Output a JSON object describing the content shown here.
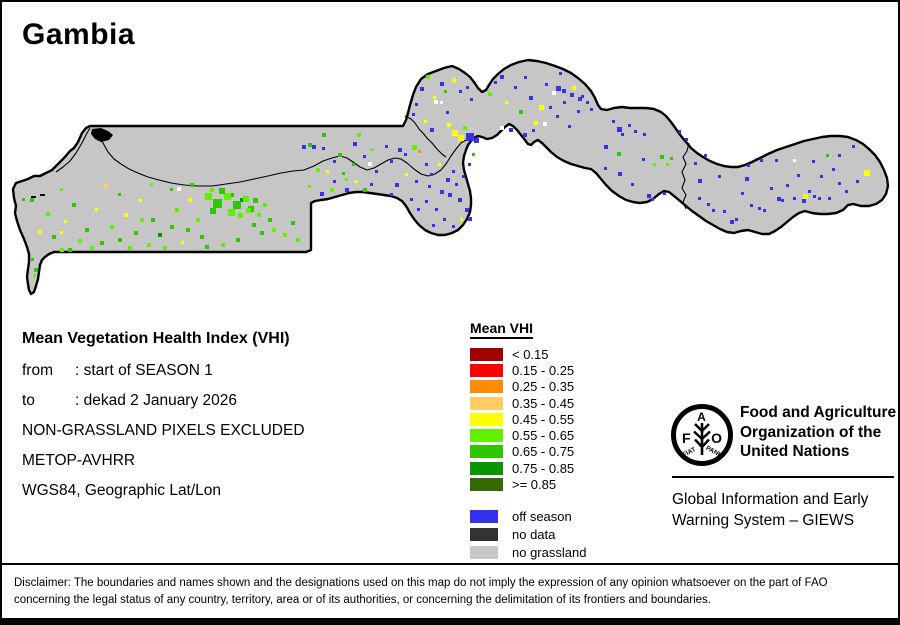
{
  "title": "Gambia",
  "info": {
    "heading": "Mean Vegetation Health Index (VHI)",
    "rows": [
      {
        "label": "from",
        "value": ": start of SEASON 1"
      },
      {
        "label": "to",
        "value": ": dekad 2 January 2026"
      }
    ],
    "lines": [
      "NON-GRASSLAND PIXELS EXCLUDED",
      "METOP-AVHRR",
      "WGS84, Geographic Lat/Lon"
    ]
  },
  "legend": {
    "title": "Mean VHI",
    "classes": [
      {
        "label": "< 0.15",
        "color": "#A00000"
      },
      {
        "label": "0.15 - 0.25",
        "color": "#FF0000"
      },
      {
        "label": "0.25 - 0.35",
        "color": "#FF8C00"
      },
      {
        "label": "0.35 - 0.45",
        "color": "#FFCC66"
      },
      {
        "label": "0.45 - 0.55",
        "color": "#FFFF00"
      },
      {
        "label": "0.55 - 0.65",
        "color": "#63F000"
      },
      {
        "label": "0.65 - 0.75",
        "color": "#2FC800"
      },
      {
        "label": "0.75 - 0.85",
        "color": "#0A9600"
      },
      {
        "label": ">= 0.85",
        "color": "#336B00"
      }
    ],
    "extra": [
      {
        "label": "off season",
        "color": "#3333EE"
      },
      {
        "label": "no data",
        "color": "#333333"
      },
      {
        "label": "no grassland",
        "color": "#C8C8C8"
      }
    ]
  },
  "org": {
    "logo": {
      "f": "F",
      "a": "A",
      "o": "O",
      "fiat": "FIAT",
      "panis": "PANIS"
    },
    "name_lines": [
      "Food and Agriculture",
      "Organization of the",
      "United Nations"
    ],
    "giews_lines": [
      "Global Information and Early",
      "Warning System – GIEWS"
    ]
  },
  "disclaimer": {
    "line1": "Disclaimer: The boundaries and names shown and the designations used on this map do not imply the expression of any opinion whatsoever on the part of FAO",
    "line2": "concerning the legal status of any country, territory, area or of its authorities, or concerning the delimitation of its frontiers and boundaries."
  },
  "map": {
    "land_color": "#C6C6C6",
    "pixel_colors": {
      "G1": "#63F000",
      "G2": "#2FC800",
      "G3": "#0A9600",
      "G4": "#336B00",
      "Y": "#FFFF00",
      "T": "#FFCC66",
      "O": "#FF9100",
      "B": "#3333EE",
      "W": "#FFFFFF"
    },
    "pixels": [
      [
        30,
        196,
        4,
        "G2"
      ],
      [
        22,
        196,
        3,
        "G2"
      ],
      [
        38,
        228,
        4,
        "Y"
      ],
      [
        46,
        210,
        4,
        "G1"
      ],
      [
        52,
        233,
        4,
        "G2"
      ],
      [
        60,
        246,
        4,
        "G1"
      ],
      [
        64,
        218,
        3,
        "Y"
      ],
      [
        60,
        229,
        3,
        "Y"
      ],
      [
        60,
        186,
        3,
        "G1"
      ],
      [
        68,
        246,
        4,
        "G2"
      ],
      [
        72,
        201,
        4,
        "G2"
      ],
      [
        78,
        237,
        4,
        "G1"
      ],
      [
        85,
        226,
        4,
        "G2"
      ],
      [
        90,
        244,
        4,
        "G1"
      ],
      [
        95,
        206,
        3,
        "Y"
      ],
      [
        100,
        239,
        4,
        "G2"
      ],
      [
        104,
        182,
        4,
        "T"
      ],
      [
        110,
        223,
        4,
        "G1"
      ],
      [
        118,
        236,
        4,
        "G2"
      ],
      [
        118,
        191,
        3,
        "G2"
      ],
      [
        124,
        211,
        4,
        "Y"
      ],
      [
        128,
        244,
        4,
        "G1"
      ],
      [
        134,
        229,
        4,
        "G2"
      ],
      [
        139,
        197,
        3,
        "Y"
      ],
      [
        140,
        216,
        4,
        "G1"
      ],
      [
        147,
        241,
        4,
        "G1"
      ],
      [
        151,
        216,
        4,
        "G2"
      ],
      [
        150,
        181,
        3,
        "G1"
      ],
      [
        158,
        231,
        4,
        "G3"
      ],
      [
        163,
        244,
        4,
        "G1"
      ],
      [
        170,
        223,
        4,
        "G2"
      ],
      [
        170,
        186,
        3,
        "G2"
      ],
      [
        175,
        206,
        4,
        "G1"
      ],
      [
        177,
        185,
        4,
        "W"
      ],
      [
        181,
        239,
        3,
        "Y"
      ],
      [
        186,
        226,
        4,
        "G2"
      ],
      [
        188,
        196,
        4,
        "Y"
      ],
      [
        190,
        181,
        4,
        "G2"
      ],
      [
        196,
        216,
        4,
        "G1"
      ],
      [
        200,
        233,
        4,
        "G2"
      ],
      [
        205,
        243,
        4,
        "G2"
      ],
      [
        210,
        186,
        4,
        "G1"
      ],
      [
        221,
        241,
        4,
        "G1"
      ],
      [
        230,
        191,
        4,
        "G2"
      ],
      [
        236,
        236,
        4,
        "G2"
      ],
      [
        240,
        196,
        4,
        "G3"
      ],
      [
        252,
        221,
        4,
        "G2"
      ],
      [
        257,
        211,
        4,
        "G1"
      ],
      [
        260,
        229,
        4,
        "G2"
      ],
      [
        263,
        201,
        4,
        "G1"
      ],
      [
        268,
        216,
        4,
        "G2"
      ],
      [
        272,
        226,
        4,
        "G1"
      ],
      [
        283,
        231,
        4,
        "G1"
      ],
      [
        291,
        219,
        4,
        "G2"
      ],
      [
        296,
        236,
        4,
        "G1"
      ],
      [
        34,
        266,
        4,
        "G2"
      ],
      [
        31,
        256,
        3,
        "G2"
      ],
      [
        33,
        272,
        3,
        "G1"
      ],
      [
        205,
        191,
        7,
        "G1"
      ],
      [
        213,
        197,
        9,
        "G2"
      ],
      [
        224,
        191,
        7,
        "G1"
      ],
      [
        233,
        199,
        8,
        "G2"
      ],
      [
        243,
        194,
        6,
        "G1"
      ],
      [
        210,
        206,
        6,
        "G2"
      ],
      [
        228,
        207,
        7,
        "G1"
      ],
      [
        248,
        204,
        6,
        "G2"
      ],
      [
        219,
        186,
        6,
        "G2"
      ],
      [
        238,
        211,
        5,
        "G1"
      ],
      [
        253,
        196,
        5,
        "G2"
      ],
      [
        246,
        206,
        5,
        "G1"
      ],
      [
        308,
        141,
        4,
        "G2"
      ],
      [
        316,
        166,
        4,
        "G1"
      ],
      [
        322,
        131,
        4,
        "G2"
      ],
      [
        330,
        186,
        4,
        "G1"
      ],
      [
        338,
        151,
        4,
        "G2"
      ],
      [
        345,
        176,
        3,
        "G1"
      ],
      [
        352,
        161,
        3,
        "G2"
      ],
      [
        357,
        131,
        4,
        "G1"
      ],
      [
        363,
        186,
        4,
        "G2"
      ],
      [
        370,
        146,
        3,
        "G1"
      ],
      [
        302,
        143,
        4,
        "B"
      ],
      [
        312,
        143,
        4,
        "B"
      ],
      [
        322,
        145,
        3,
        "B"
      ],
      [
        333,
        158,
        3,
        "B"
      ],
      [
        353,
        140,
        4,
        "B"
      ],
      [
        363,
        153,
        3,
        "B"
      ],
      [
        375,
        168,
        3,
        "B"
      ],
      [
        385,
        143,
        3,
        "B"
      ],
      [
        390,
        158,
        3,
        "B"
      ],
      [
        368,
        160,
        4,
        "W"
      ],
      [
        342,
        170,
        3,
        "G2"
      ],
      [
        333,
        178,
        3,
        "B"
      ],
      [
        345,
        186,
        4,
        "B"
      ],
      [
        355,
        178,
        3,
        "Y"
      ],
      [
        320,
        190,
        4,
        "B"
      ],
      [
        308,
        183,
        3,
        "G1"
      ],
      [
        326,
        168,
        3,
        "Y"
      ],
      [
        398,
        146,
        4,
        "B"
      ],
      [
        404,
        151,
        3,
        "B"
      ],
      [
        412,
        143,
        5,
        "G1"
      ],
      [
        418,
        148,
        3,
        "O"
      ],
      [
        425,
        161,
        3,
        "B"
      ],
      [
        430,
        171,
        3,
        "B"
      ],
      [
        438,
        161,
        3,
        "Y"
      ],
      [
        446,
        176,
        4,
        "B"
      ],
      [
        452,
        168,
        3,
        "B"
      ],
      [
        440,
        188,
        4,
        "B"
      ],
      [
        428,
        183,
        3,
        "B"
      ],
      [
        415,
        178,
        3,
        "B"
      ],
      [
        405,
        171,
        3,
        "Y"
      ],
      [
        395,
        181,
        4,
        "B"
      ],
      [
        390,
        191,
        3,
        "B"
      ],
      [
        370,
        181,
        3,
        "B"
      ],
      [
        448,
        191,
        4,
        "B"
      ],
      [
        455,
        181,
        3,
        "B"
      ],
      [
        462,
        173,
        3,
        "B"
      ],
      [
        458,
        196,
        4,
        "B"
      ],
      [
        465,
        206,
        4,
        "B"
      ],
      [
        468,
        215,
        4,
        "B"
      ],
      [
        460,
        216,
        3,
        "Y"
      ],
      [
        452,
        223,
        3,
        "B"
      ],
      [
        443,
        216,
        3,
        "B"
      ],
      [
        435,
        206,
        3,
        "B"
      ],
      [
        425,
        198,
        3,
        "B"
      ],
      [
        417,
        206,
        3,
        "B"
      ],
      [
        410,
        196,
        3,
        "B"
      ],
      [
        432,
        222,
        3,
        "B"
      ],
      [
        452,
        128,
        6,
        "Y"
      ],
      [
        458,
        133,
        6,
        "Y"
      ],
      [
        466,
        131,
        8,
        "B"
      ],
      [
        474,
        136,
        5,
        "B"
      ],
      [
        463,
        124,
        4,
        "G1"
      ],
      [
        447,
        121,
        4,
        "Y"
      ],
      [
        430,
        126,
        4,
        "B"
      ],
      [
        424,
        118,
        3,
        "Y"
      ],
      [
        434,
        98,
        4,
        "W"
      ],
      [
        440,
        99,
        3,
        "W"
      ],
      [
        472,
        151,
        3,
        "G2"
      ],
      [
        468,
        161,
        3,
        "B"
      ],
      [
        420,
        85,
        4,
        "B"
      ],
      [
        426,
        73,
        4,
        "G1"
      ],
      [
        433,
        94,
        3,
        "Y"
      ],
      [
        440,
        80,
        4,
        "B"
      ],
      [
        446,
        109,
        3,
        "B"
      ],
      [
        452,
        76,
        4,
        "Y"
      ],
      [
        459,
        88,
        3,
        "B"
      ],
      [
        466,
        84,
        3,
        "B"
      ],
      [
        470,
        96,
        3,
        "B"
      ],
      [
        444,
        88,
        3,
        "G2"
      ],
      [
        415,
        101,
        3,
        "B"
      ],
      [
        412,
        111,
        3,
        "B"
      ],
      [
        488,
        90,
        4,
        "G1"
      ],
      [
        494,
        79,
        3,
        "B"
      ],
      [
        500,
        73,
        4,
        "B"
      ],
      [
        505,
        99,
        3,
        "Y"
      ],
      [
        509,
        126,
        4,
        "B"
      ],
      [
        514,
        84,
        3,
        "B"
      ],
      [
        519,
        108,
        4,
        "G2"
      ],
      [
        524,
        74,
        3,
        "B"
      ],
      [
        529,
        94,
        4,
        "B"
      ],
      [
        534,
        119,
        4,
        "Y"
      ],
      [
        539,
        103,
        5,
        "Y"
      ],
      [
        545,
        81,
        3,
        "B"
      ],
      [
        549,
        104,
        3,
        "B"
      ],
      [
        552,
        89,
        4,
        "W"
      ],
      [
        556,
        113,
        3,
        "B"
      ],
      [
        559,
        70,
        3,
        "B"
      ],
      [
        563,
        99,
        3,
        "B"
      ],
      [
        568,
        123,
        3,
        "B"
      ],
      [
        572,
        84,
        4,
        "Y"
      ],
      [
        577,
        108,
        3,
        "B"
      ],
      [
        581,
        93,
        3,
        "B"
      ],
      [
        556,
        84,
        5,
        "B"
      ],
      [
        562,
        87,
        4,
        "B"
      ],
      [
        570,
        91,
        4,
        "B"
      ],
      [
        578,
        95,
        4,
        "B"
      ],
      [
        586,
        99,
        3,
        "B"
      ],
      [
        590,
        106,
        3,
        "B"
      ],
      [
        543,
        120,
        4,
        "W"
      ],
      [
        500,
        124,
        4,
        "W"
      ],
      [
        585,
        70,
        3,
        "W"
      ],
      [
        523,
        131,
        4,
        "B"
      ],
      [
        532,
        127,
        3,
        "B"
      ],
      [
        604,
        143,
        4,
        "B"
      ],
      [
        612,
        118,
        3,
        "B"
      ],
      [
        617,
        125,
        5,
        "B"
      ],
      [
        621,
        131,
        3,
        "B"
      ],
      [
        617,
        150,
        4,
        "G2"
      ],
      [
        628,
        122,
        3,
        "B"
      ],
      [
        634,
        128,
        3,
        "B"
      ],
      [
        642,
        156,
        3,
        "B"
      ],
      [
        653,
        161,
        3,
        "G1"
      ],
      [
        660,
        153,
        4,
        "G2"
      ],
      [
        666,
        161,
        3,
        "G1"
      ],
      [
        670,
        155,
        3,
        "G2"
      ],
      [
        647,
        192,
        4,
        "B"
      ],
      [
        651,
        196,
        3,
        "B"
      ],
      [
        663,
        190,
        3,
        "B"
      ],
      [
        678,
        128,
        3,
        "B"
      ],
      [
        685,
        136,
        3,
        "B"
      ],
      [
        618,
        170,
        4,
        "B"
      ],
      [
        643,
        131,
        3,
        "B"
      ],
      [
        604,
        165,
        3,
        "B"
      ],
      [
        631,
        181,
        3,
        "B"
      ],
      [
        698,
        177,
        4,
        "B"
      ],
      [
        698,
        195,
        3,
        "B"
      ],
      [
        707,
        201,
        3,
        "B"
      ],
      [
        712,
        207,
        3,
        "B"
      ],
      [
        723,
        208,
        3,
        "B"
      ],
      [
        730,
        218,
        4,
        "B"
      ],
      [
        735,
        216,
        3,
        "B"
      ],
      [
        745,
        175,
        4,
        "B"
      ],
      [
        750,
        202,
        3,
        "B"
      ],
      [
        758,
        205,
        3,
        "B"
      ],
      [
        763,
        207,
        3,
        "B"
      ],
      [
        777,
        195,
        4,
        "B"
      ],
      [
        781,
        197,
        3,
        "B"
      ],
      [
        793,
        195,
        3,
        "B"
      ],
      [
        802,
        197,
        4,
        "B"
      ],
      [
        803,
        192,
        5,
        "Y"
      ],
      [
        813,
        193,
        3,
        "B"
      ],
      [
        818,
        195,
        3,
        "B"
      ],
      [
        828,
        195,
        3,
        "B"
      ],
      [
        838,
        180,
        3,
        "B"
      ],
      [
        852,
        143,
        3,
        "B"
      ],
      [
        864,
        168,
        6,
        "Y"
      ],
      [
        845,
        188,
        3,
        "B"
      ],
      [
        856,
        178,
        3,
        "B"
      ],
      [
        808,
        188,
        3,
        "B"
      ],
      [
        718,
        173,
        3,
        "B"
      ],
      [
        704,
        152,
        3,
        "B"
      ],
      [
        694,
        160,
        3,
        "B"
      ],
      [
        741,
        190,
        3,
        "B"
      ],
      [
        770,
        185,
        3,
        "B"
      ],
      [
        786,
        182,
        3,
        "B"
      ],
      [
        797,
        172,
        3,
        "B"
      ],
      [
        820,
        173,
        3,
        "B"
      ],
      [
        832,
        166,
        3,
        "B"
      ],
      [
        747,
        162,
        3,
        "B"
      ],
      [
        760,
        157,
        3,
        "B"
      ],
      [
        775,
        157,
        3,
        "B"
      ],
      [
        793,
        157,
        3,
        "W"
      ],
      [
        812,
        158,
        3,
        "B"
      ],
      [
        826,
        152,
        3,
        "G2"
      ],
      [
        838,
        152,
        3,
        "B"
      ]
    ]
  }
}
